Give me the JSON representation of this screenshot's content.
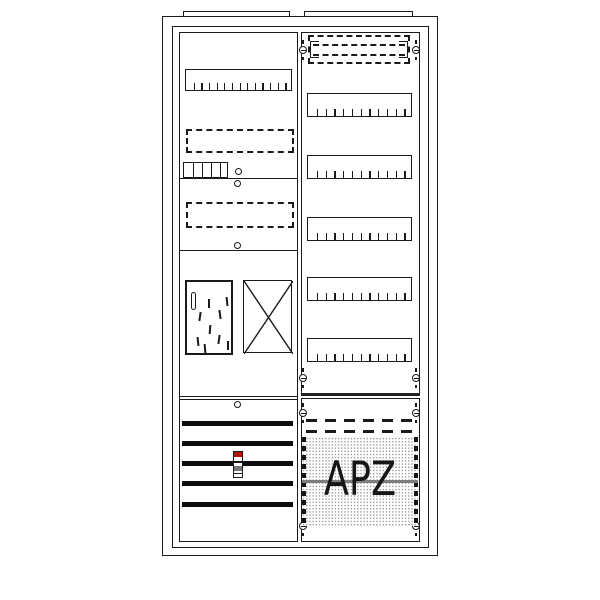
{
  "meta": {
    "description": "two-field electrical meter cabinet line diagram with APZ area"
  },
  "labels": {
    "apz": "APZ"
  },
  "colors": {
    "line": "#1a1a1a",
    "thick_line": "#222222",
    "bar_fill": "#0d0d0d",
    "device_red": "#b3140e",
    "device_gray": "#777777",
    "apz_gray_line": "#7d7d7d",
    "stipple_dot": "#9f9f9f",
    "stipple_bg": "#fdfdfd",
    "background": "#ffffff"
  },
  "geometry": {
    "frames": [
      {
        "name": "cabinet-outer-frame",
        "x": 162,
        "y": 16,
        "w": 276,
        "h": 540,
        "bw": 1.6
      },
      {
        "name": "cabinet-inner-frame",
        "x": 172,
        "y": 26,
        "w": 257,
        "h": 522,
        "bw": 1.2
      }
    ],
    "tabs": [
      {
        "name": "mounting-tab-left",
        "x": 183,
        "y": 11,
        "w": 107,
        "h": 6
      },
      {
        "name": "mounting-tab-right",
        "x": 304,
        "y": 11,
        "w": 109,
        "h": 6
      }
    ],
    "panels": [
      {
        "name": "left-field-panel",
        "x": 179,
        "y": 32,
        "w": 119,
        "h": 510
      },
      {
        "name": "right-field-upper-panel",
        "x": 301,
        "y": 32,
        "w": 119,
        "h": 364
      },
      {
        "name": "right-field-lower-panel",
        "x": 301,
        "y": 398,
        "w": 119,
        "h": 144
      }
    ],
    "left": {
      "rail": {
        "name": "device-rail-left",
        "x": 185,
        "y": 69,
        "w": 107,
        "h": 22,
        "ticks": 13
      },
      "dashed_rects": [
        {
          "name": "reserved-area-dashed",
          "x": 186,
          "y": 129,
          "w": 108,
          "h": 24
        },
        {
          "name": "reserved-area-dashed",
          "x": 186,
          "y": 202,
          "w": 108,
          "h": 26
        }
      ],
      "comb": {
        "name": "terminal-strip",
        "x": 183,
        "y": 162,
        "w": 45,
        "h": 16,
        "cells": 5
      },
      "dividers": [
        {
          "name": "section-divider",
          "x": 179,
          "y": 178,
          "w": 119
        },
        {
          "name": "section-divider",
          "x": 179,
          "y": 250,
          "w": 119
        },
        {
          "name": "section-divider",
          "x": 179,
          "y": 396,
          "w": 119
        },
        {
          "name": "section-divider",
          "x": 179,
          "y": 399,
          "w": 119
        }
      ],
      "screws": [
        {
          "x": 238,
          "y": 171
        },
        {
          "x": 237,
          "y": 183
        },
        {
          "x": 237,
          "y": 245
        },
        {
          "x": 237,
          "y": 404
        }
      ],
      "meter": {
        "name": "meter-plate",
        "x": 185,
        "y": 280,
        "w": 48,
        "h": 75,
        "slot": {
          "x": 191,
          "y": 292,
          "w": 5,
          "h": 18
        },
        "marks": [
          {
            "x": 208,
            "y": 299,
            "r": 0
          },
          {
            "x": 226,
            "y": 297,
            "r": -6
          },
          {
            "x": 199,
            "y": 312,
            "r": 8
          },
          {
            "x": 219,
            "y": 310,
            "r": -8
          },
          {
            "x": 209,
            "y": 325,
            "r": 4
          },
          {
            "x": 197,
            "y": 337,
            "r": -6
          },
          {
            "x": 218,
            "y": 335,
            "r": 8
          },
          {
            "x": 227,
            "y": 341,
            "r": 0
          },
          {
            "x": 204,
            "y": 344,
            "r": -5
          }
        ]
      },
      "xbox": {
        "name": "reserved-space-crossed",
        "x": 243,
        "y": 280,
        "w": 49,
        "h": 73
      },
      "busbars": {
        "name": "busbar",
        "x": 182,
        "w": 111,
        "h": 5,
        "ys": [
          421,
          441,
          461,
          481,
          502
        ]
      },
      "device": {
        "name": "sealable-terminal-device",
        "x": 233,
        "y": 451,
        "w": 10,
        "h": 27,
        "segments": [
          {
            "h": 5,
            "c": "device_red"
          },
          {
            "h": 4,
            "c": "#ffffff"
          },
          {
            "h": 1.5,
            "c": "#1a1a1a"
          },
          {
            "h": 3,
            "c": "#ffffff"
          },
          {
            "h": 5,
            "c": "device_gray"
          },
          {
            "h": 2,
            "c": "#ffffff"
          },
          {
            "h": 1.5,
            "c": "#1a1a1a"
          },
          {
            "h": 5,
            "c": "#ffffff"
          }
        ]
      }
    },
    "right": {
      "dashed_box": {
        "name": "cover-strip-dashed",
        "x": 308,
        "y": 35,
        "w": 102,
        "h": 29,
        "inner_lines": [
          44,
          54
        ],
        "inner_x": 313,
        "inner_w": 92,
        "brackets": [
          {
            "x": 310,
            "y": 41,
            "w": 9,
            "h": 17,
            "side": "left"
          },
          {
            "x": 399,
            "y": 41,
            "w": 9,
            "h": 17,
            "side": "right"
          }
        ]
      },
      "rails": {
        "name": "device-rail-right",
        "x": 307,
        "w": 105,
        "h": 24,
        "ticks": 11,
        "ys": [
          93,
          155,
          217,
          277,
          338
        ]
      },
      "screws": [
        {
          "x": 303,
          "y": 50
        },
        {
          "x": 416,
          "y": 50
        },
        {
          "x": 303,
          "y": 378
        },
        {
          "x": 416,
          "y": 378
        },
        {
          "x": 303,
          "y": 413
        },
        {
          "x": 416,
          "y": 413
        },
        {
          "x": 303,
          "y": 526
        },
        {
          "x": 416,
          "y": 526
        }
      ],
      "thick_line": {
        "name": "field-divider",
        "x": 301,
        "y": 393,
        "w": 119,
        "h": 3
      },
      "dash_lines": [
        {
          "name": "cover-dashed-line",
          "x": 306,
          "y": 419,
          "w": 108
        },
        {
          "name": "cover-dashed-line",
          "x": 306,
          "y": 430,
          "w": 108
        }
      ],
      "stipple": {
        "name": "apz-area",
        "x": 302,
        "y": 437,
        "w": 116,
        "h": 89,
        "edge_w": 4,
        "gray_line_y": 480
      }
    }
  }
}
